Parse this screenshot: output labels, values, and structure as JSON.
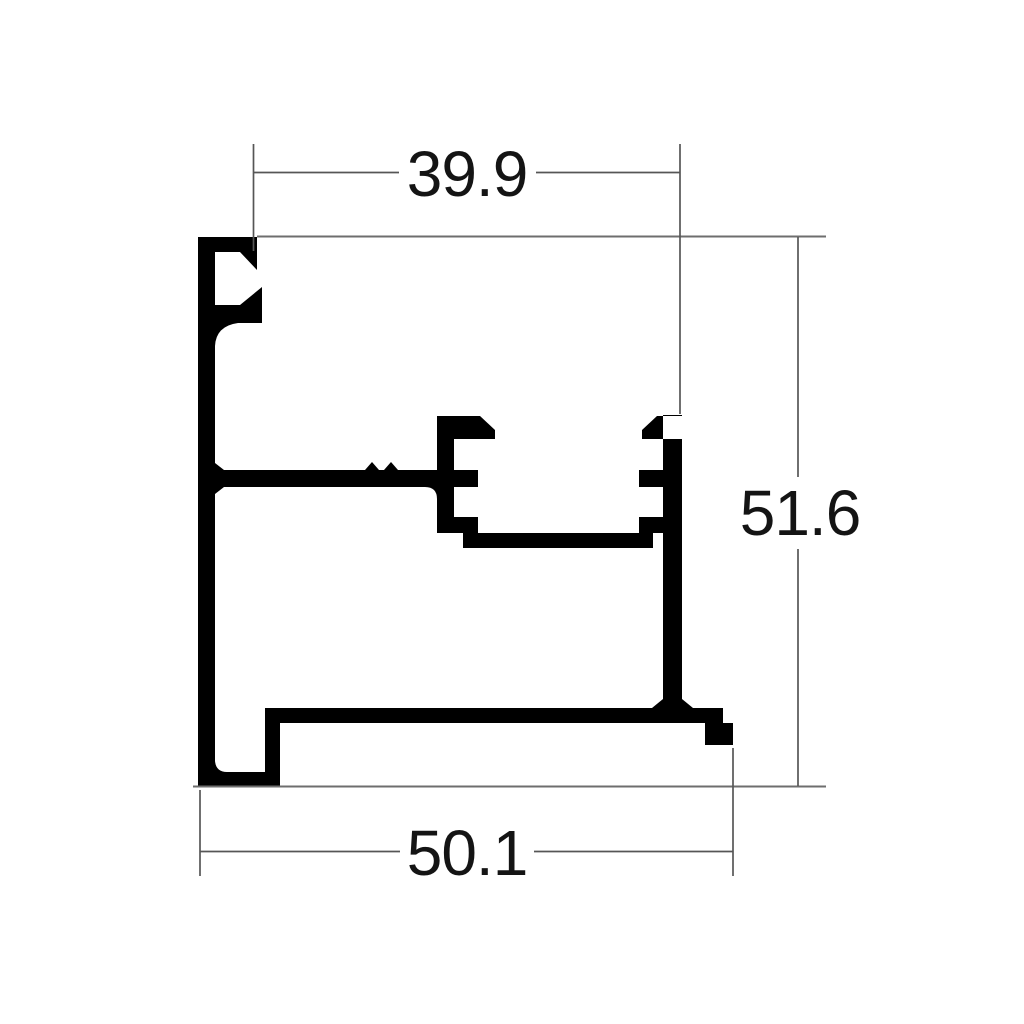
{
  "drawing": {
    "title": "aluminium-profile-cross-section",
    "dimensions": {
      "top_width": "39.9",
      "right_height": "51.6",
      "bottom_width": "50.1"
    },
    "colors": {
      "profile_fill": "#000000",
      "dimension_lines": "#565656",
      "reference_lines": "#6e6e6e",
      "text": "#141414",
      "background": "#ffffff"
    }
  }
}
